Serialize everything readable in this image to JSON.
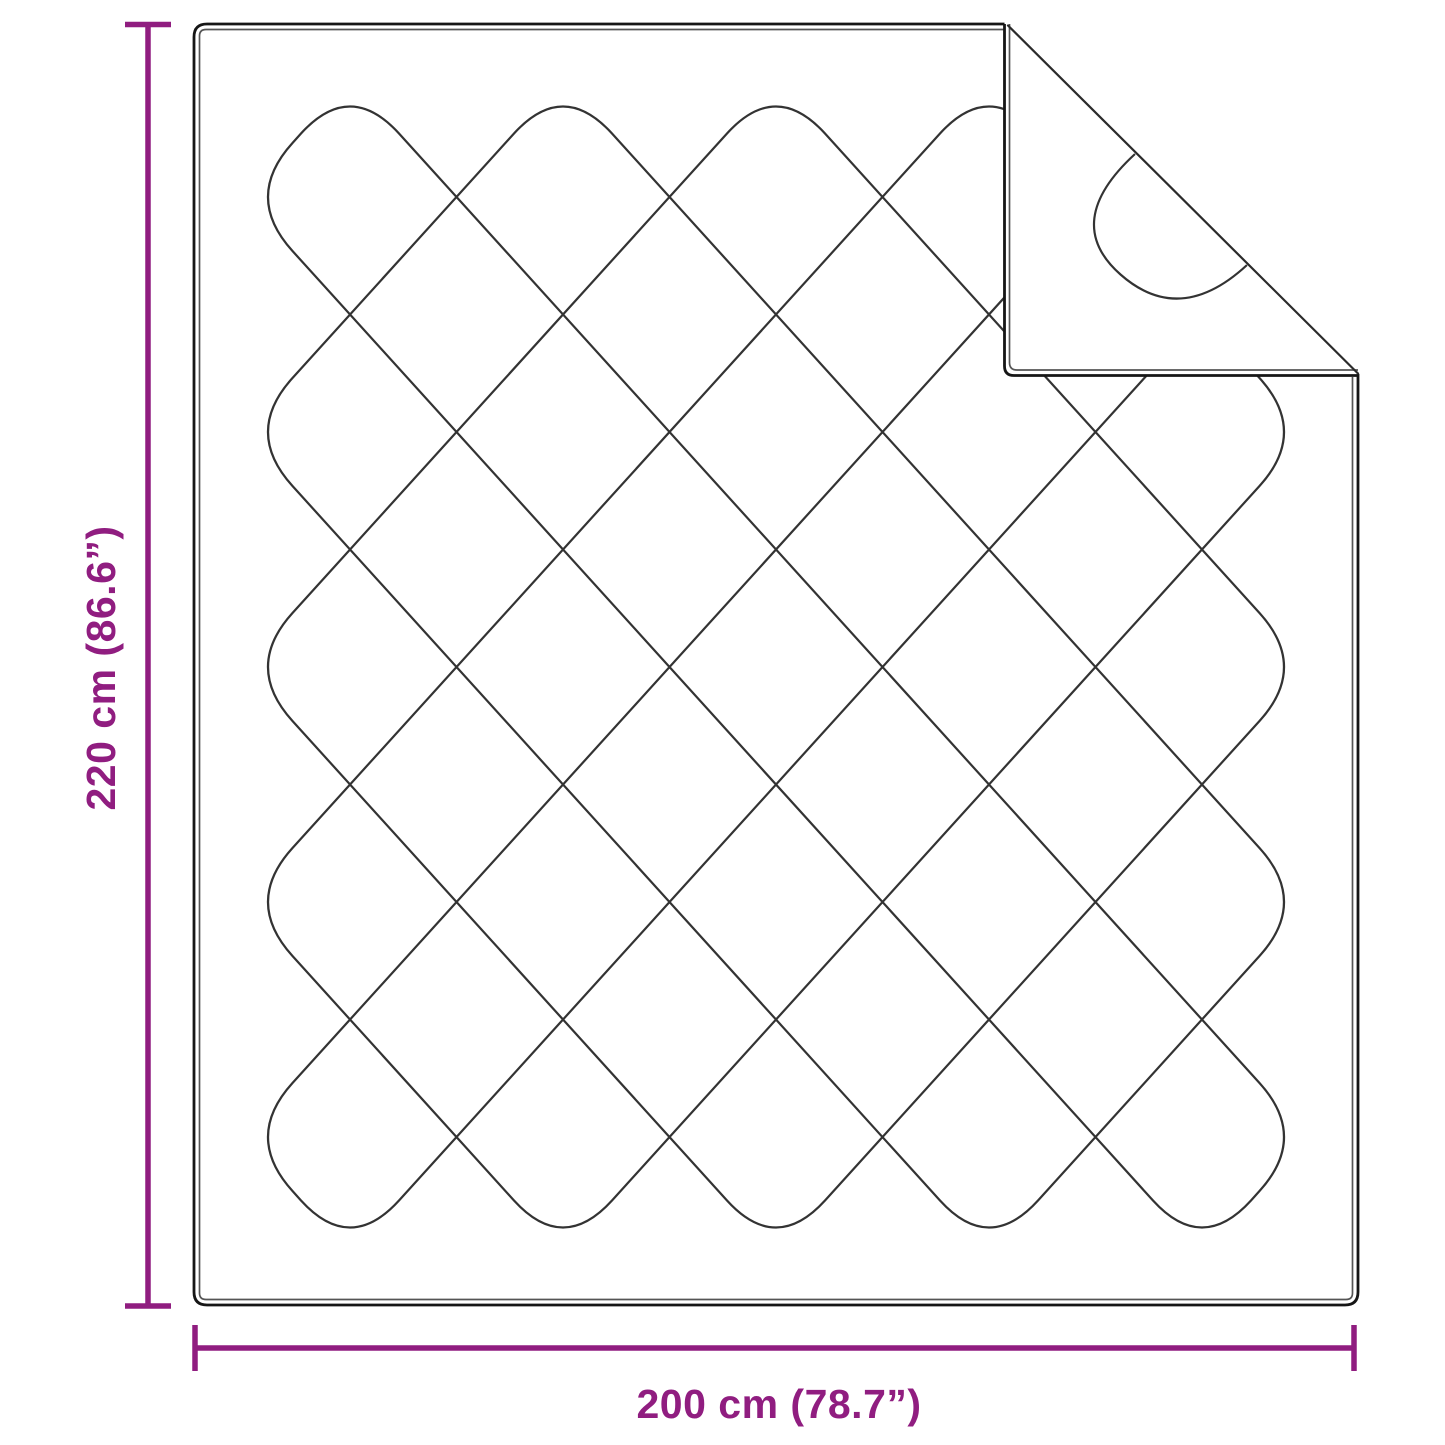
{
  "dimensions": {
    "height_label": "220 cm (86.6”)",
    "width_label": "200 cm (78.7”)"
  },
  "colors": {
    "accent": "#901d80",
    "outline": "#161616",
    "stitch": "#333333"
  }
}
